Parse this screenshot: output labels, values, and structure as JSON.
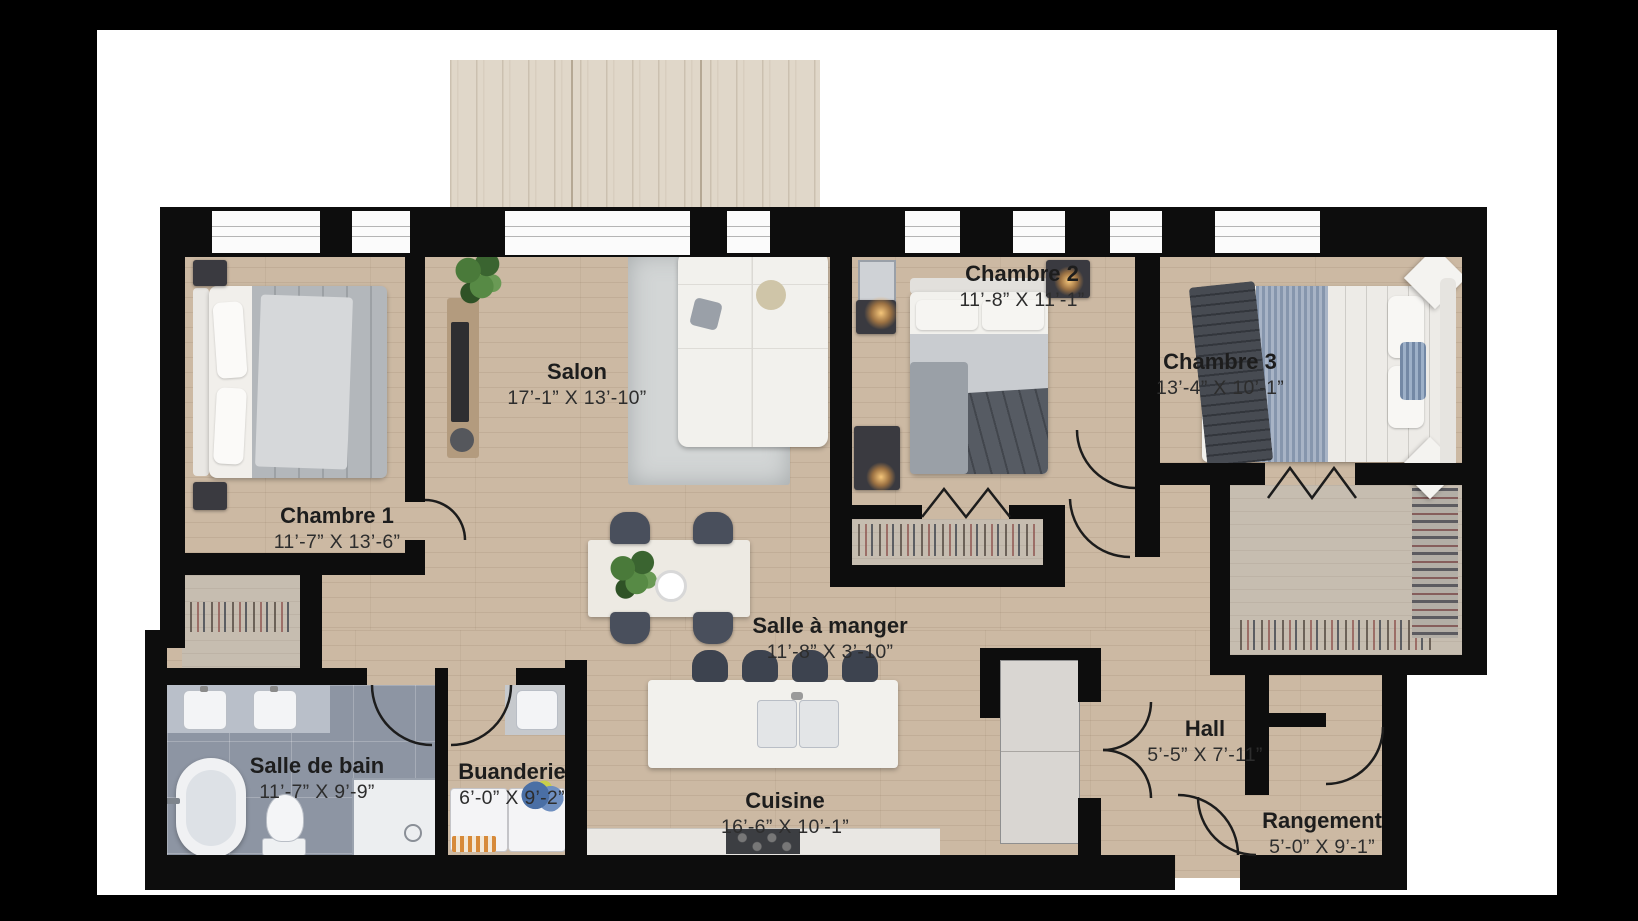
{
  "rooms": [
    {
      "name": "Salon",
      "dims": "17’-1” X 13’-10”"
    },
    {
      "name": "Chambre 1",
      "dims": "11’-7” X 13’-6”"
    },
    {
      "name": "Chambre 2",
      "dims": "11’-8” X 11’-1”"
    },
    {
      "name": "Chambre 3",
      "dims": "13’-4” X 10’-1”"
    },
    {
      "name": "Salle à manger",
      "dims": "11’-8” X 3’-10”"
    },
    {
      "name": "Salle de bain",
      "dims": "11’-7” X 9’-9”"
    },
    {
      "name": "Buanderie",
      "dims": "6’-0” X 9’-2”"
    },
    {
      "name": "Cuisine",
      "dims": "16’-6” X 10’-1”"
    },
    {
      "name": "Hall",
      "dims": "5’-5” X 7’-11”"
    },
    {
      "name": "Rangement",
      "dims": "5’-0” X 9’-1”"
    }
  ],
  "colors": {
    "frame": "#000000",
    "page": "#ffffff",
    "wall": "#0d0d0d",
    "wood_floor": "#ccb9a3",
    "bathroom_tile": "#8d95a3",
    "balcony_wood": "#e0d7c9",
    "label_text": "#1d1d1d"
  }
}
